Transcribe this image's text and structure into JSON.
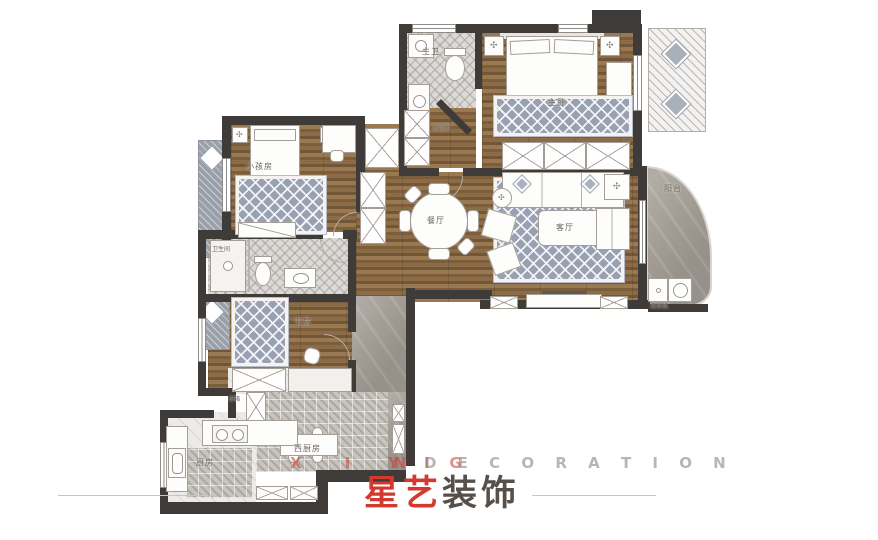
{
  "brand": {
    "watermark_part1": "X I N G",
    "watermark_part2": "Y I",
    "watermark_part3": "D E C O R A T I O N",
    "logo_red": "星艺",
    "logo_dark": "装饰"
  },
  "rooms": {
    "master_bedroom": "主卧",
    "master_bath": "主卫",
    "cloakroom": "衣帽间",
    "kids_room": "小孩房",
    "dining_room": "餐厅",
    "living_room": "客厅",
    "balcony": "阳台",
    "bathroom": "卫生间",
    "study": "书房",
    "kitchen": "厨房",
    "west_kitchen": "西厨房"
  },
  "appliances": {
    "fridge": "冰箱",
    "washer": "洗衣机"
  },
  "icons": {
    "flower": "✣"
  },
  "colors": {
    "accent_red": "#d23a30",
    "logo_dark": "#57504a",
    "wall": "#3e3b39",
    "wood": "#8a6b46",
    "rug": "#98a0b2",
    "stone": "#a39d95"
  }
}
